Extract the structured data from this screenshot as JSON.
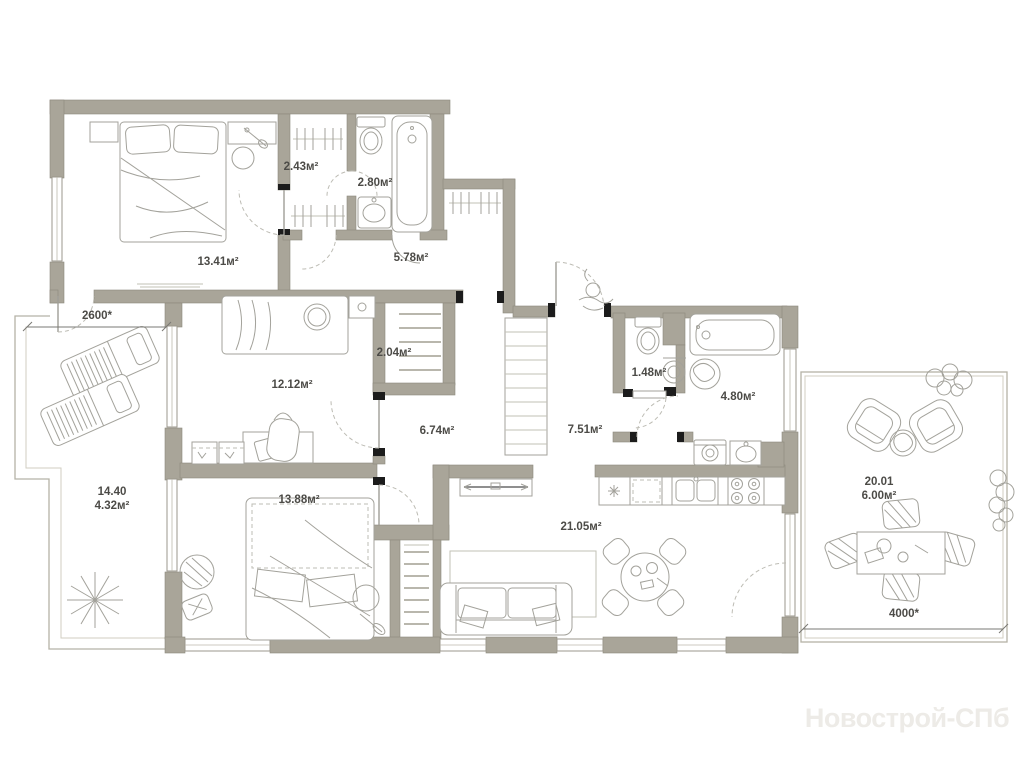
{
  "plan": {
    "watermark": "Новострой-СПб",
    "rooms": {
      "bedroom1": {
        "area": "13.41м²"
      },
      "wardrobe": {
        "area": "2.43м²"
      },
      "bathroom1": {
        "area": "2.80м²"
      },
      "hallway": {
        "area": "5.78м²"
      },
      "bedroom2": {
        "area": "12.12м²"
      },
      "closet": {
        "area": "2.04м²"
      },
      "corridor": {
        "area": "6.74м²"
      },
      "entry_hall": {
        "area": "7.51м²"
      },
      "wc": {
        "area": "1.48м²"
      },
      "bathroom2": {
        "area": "4.80м²"
      },
      "bedroom3": {
        "area": "13.88м²"
      },
      "kitchen_living": {
        "area": "21.05м²"
      },
      "balcony": {
        "number": "14.40",
        "area": "4.32м²"
      },
      "terrace": {
        "number": "20.01",
        "area": "6.00м²"
      }
    },
    "dimensions": {
      "balcony_width": "2600*",
      "terrace_width": "4000*"
    },
    "colors": {
      "wall": "#a9a599",
      "furniture_line": "#a3a29b",
      "label_text": "#4c4b47",
      "watermark_text": "#edebe7"
    }
  }
}
